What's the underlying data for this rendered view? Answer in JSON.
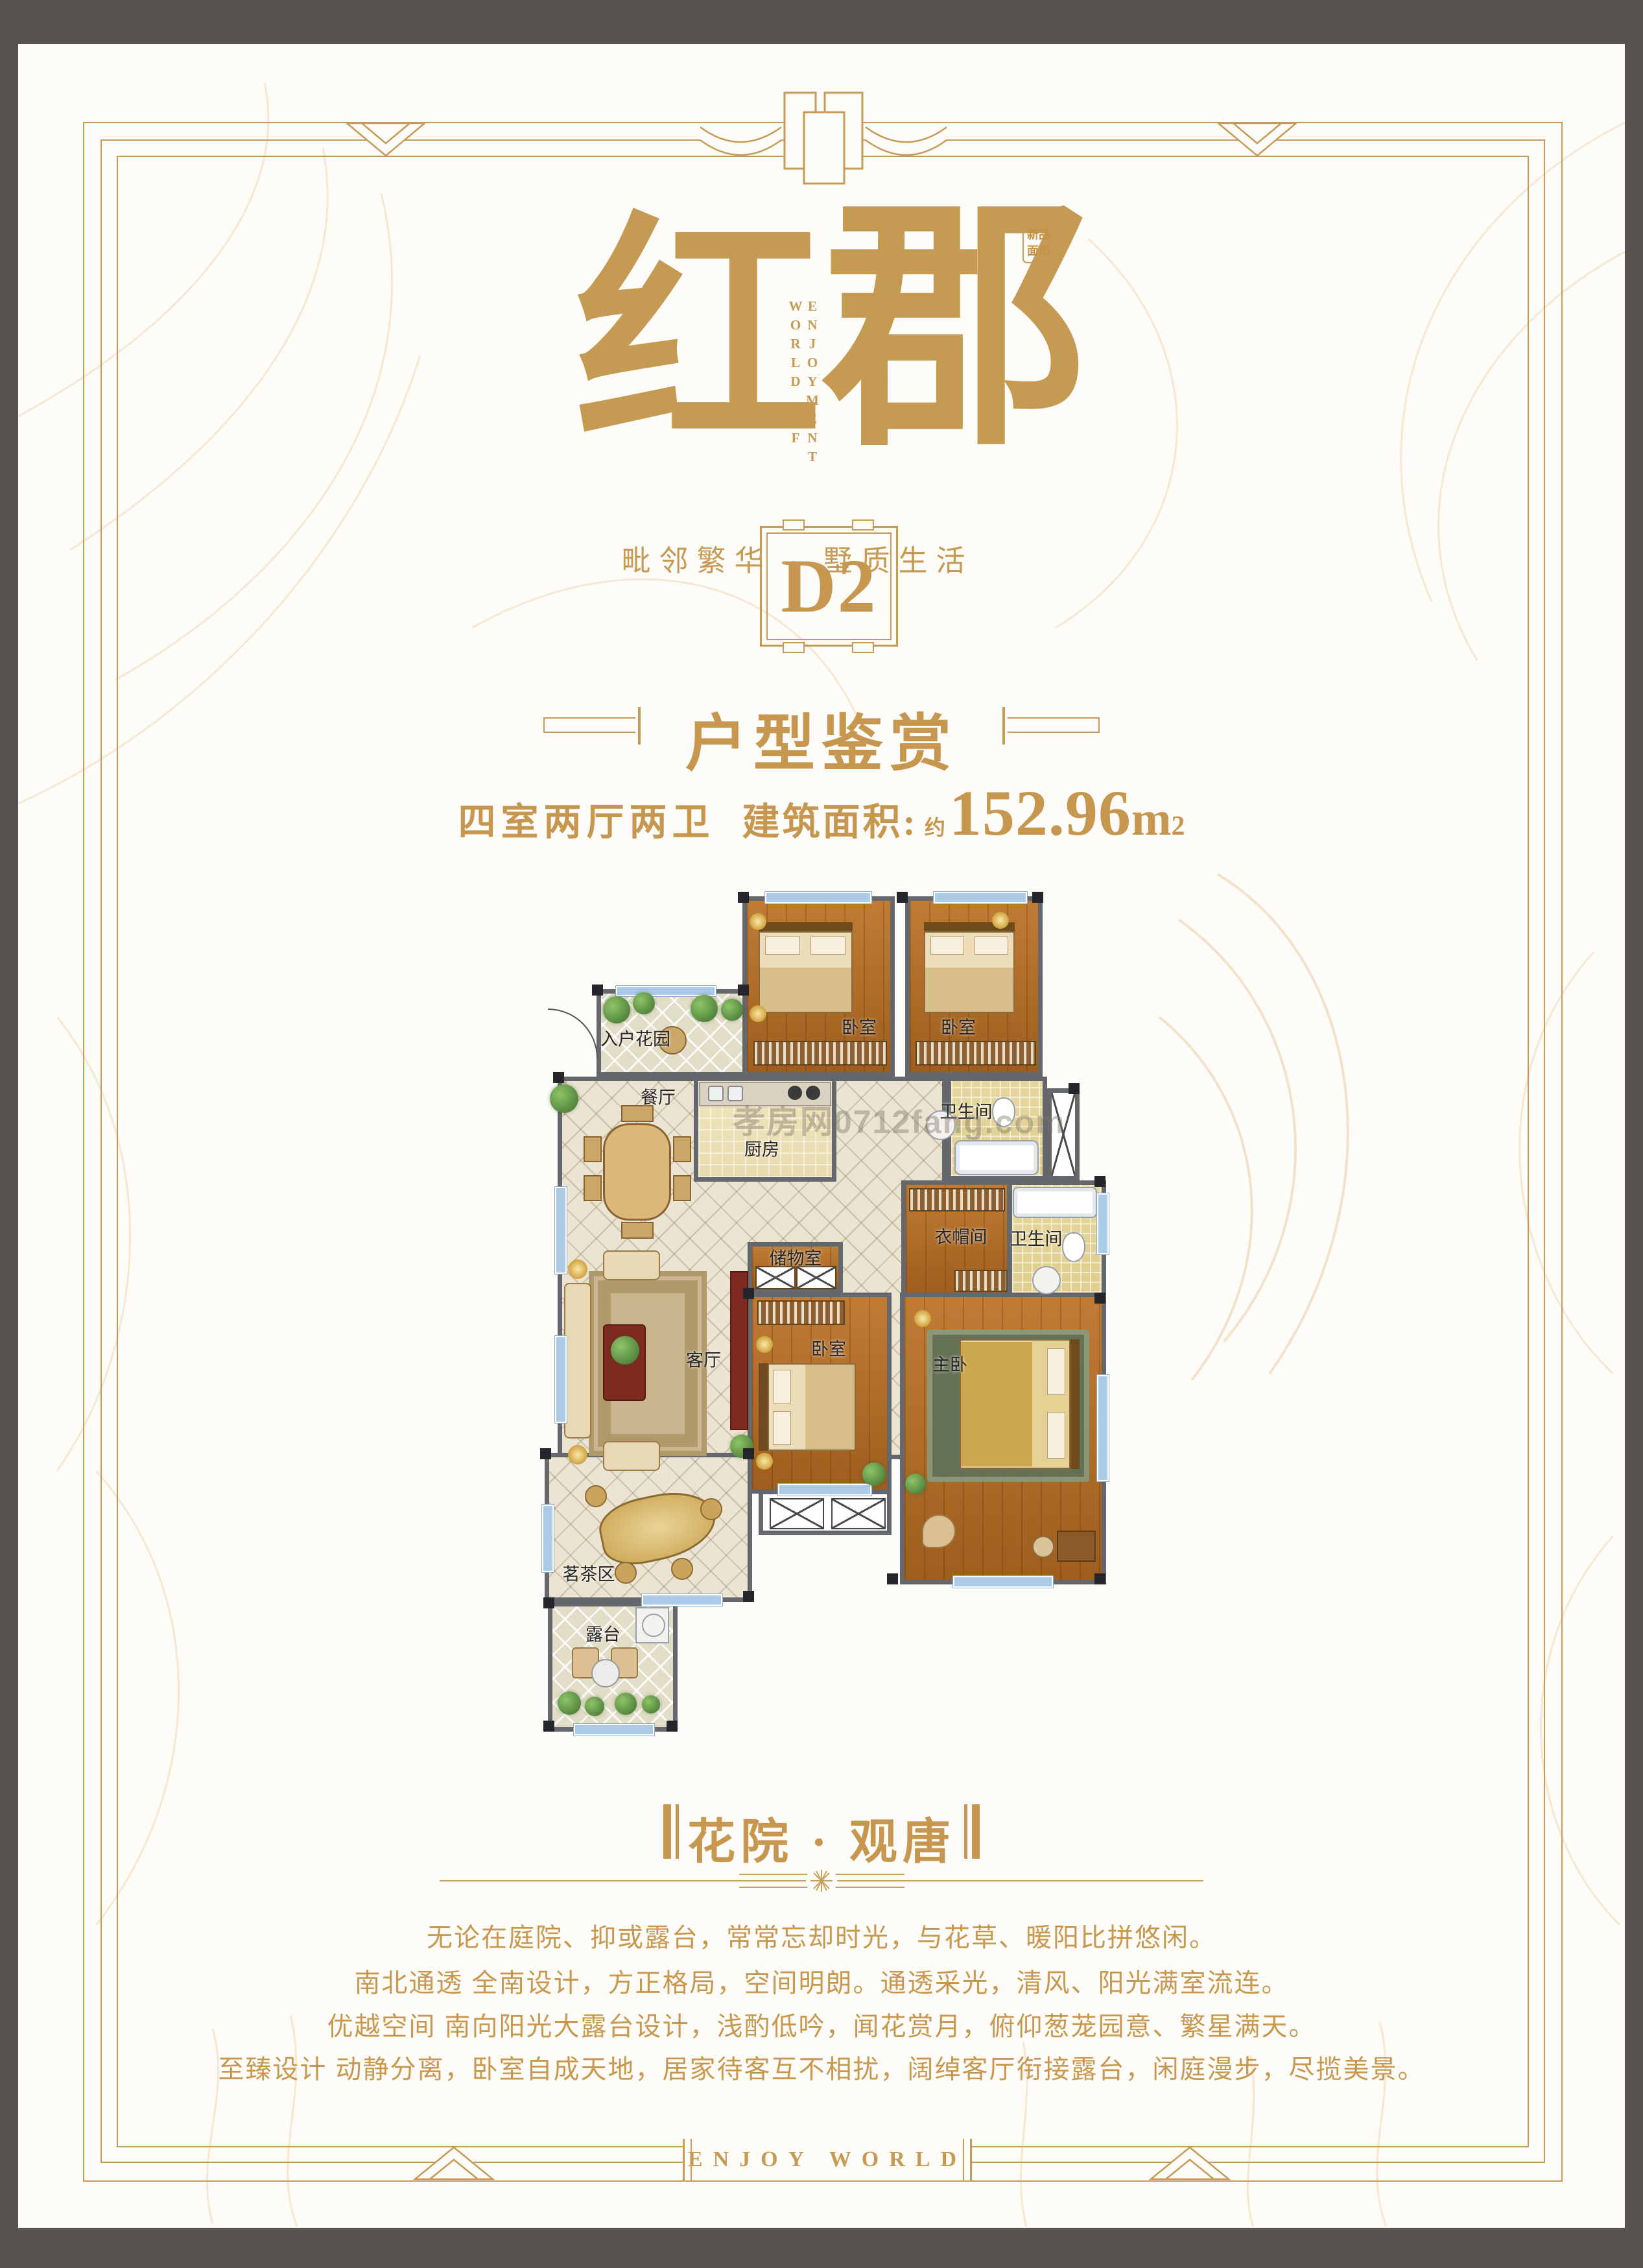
{
  "logo": {
    "char_left": "红",
    "char_right": "郡",
    "english_line1": "WORLD",
    "english_line2": "OF ENJOYMENT",
    "seal_line1": "新品",
    "seal_line2": "面市",
    "tagline": "毗邻繁华 · 墅质生活"
  },
  "unit_badge": "D2",
  "section_title": "户型鉴赏",
  "spec": {
    "rooms": "四室两厅两卫",
    "area_label": "建筑面积:",
    "approx": "约",
    "area_value": "152.96",
    "area_unit": "m",
    "area_sup": "2"
  },
  "floorplan": {
    "room_labels": [
      "入户花园",
      "卧室",
      "卧室",
      "厨房",
      "餐厅",
      "卫生间",
      "衣帽间",
      "卫生间",
      "储物室",
      "客厅",
      "卧室",
      "主卧",
      "茗茶区",
      "露台"
    ],
    "watermark": "孝房网0712fang.com"
  },
  "slogan": "花院 · 观唐",
  "paragraphs": [
    "无论在庭院、抑或露台，常常忘却时光，与花草、暖阳比拼悠闲。",
    "南北通透 全南设计，方正格局，空间明朗。通透采光，清风、阳光满室流连。",
    "优越空间 南向阳光大露台设计，浅酌低吟，闻花赏月，俯仰葱茏园意、繁星满天。",
    "至臻设计 动静分离，卧室自成天地，居家待客互不相扰，阔绰客厅衔接露台，闲庭漫步，尽揽美景。"
  ],
  "footer": "ENJOY WORLD",
  "colors": {
    "gold": "#c79750",
    "frame_gold": "#c89a58",
    "background": "#fdfcf8",
    "outer_gray": "#585350",
    "wall": "#64686d",
    "wood": "#b5772e",
    "tile": "#ece4d2",
    "bath": "#e6d79e",
    "window_blue": "#abcbe7"
  }
}
